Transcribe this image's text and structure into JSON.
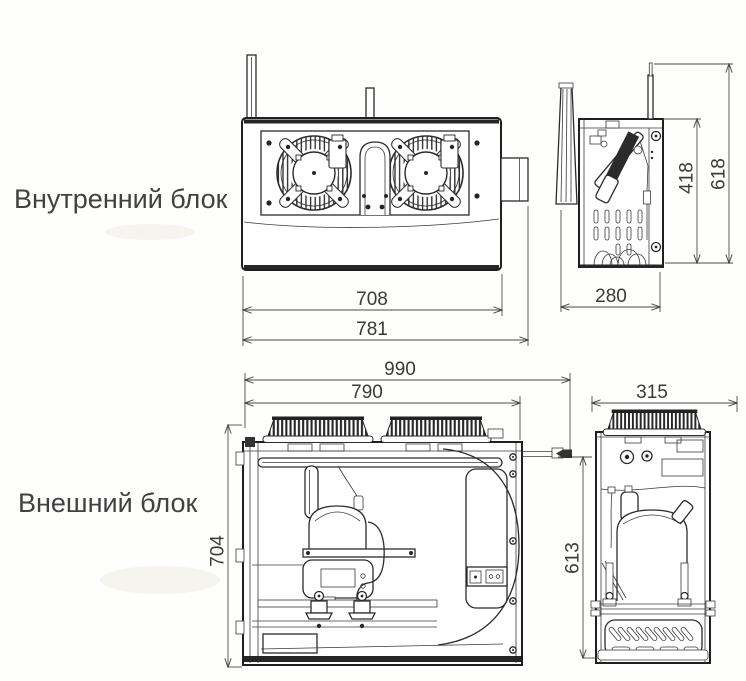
{
  "labels": {
    "internal_unit": "Внутренний блок",
    "external_unit": "Внешний блок"
  },
  "dims": {
    "internal_front": {
      "body_width": "708",
      "overall_width": "781"
    },
    "internal_side": {
      "depth": "280",
      "body_height": "418",
      "overall_height": "618"
    },
    "external_front": {
      "overall_width": "990",
      "body_width": "790",
      "height": "704"
    },
    "external_side": {
      "depth": "315",
      "height": "613"
    }
  },
  "colors": {
    "background": "#fefefd",
    "line": "#2b2b2b",
    "dimension_line": "#4b4b4b",
    "text": "#3a3a3a"
  }
}
